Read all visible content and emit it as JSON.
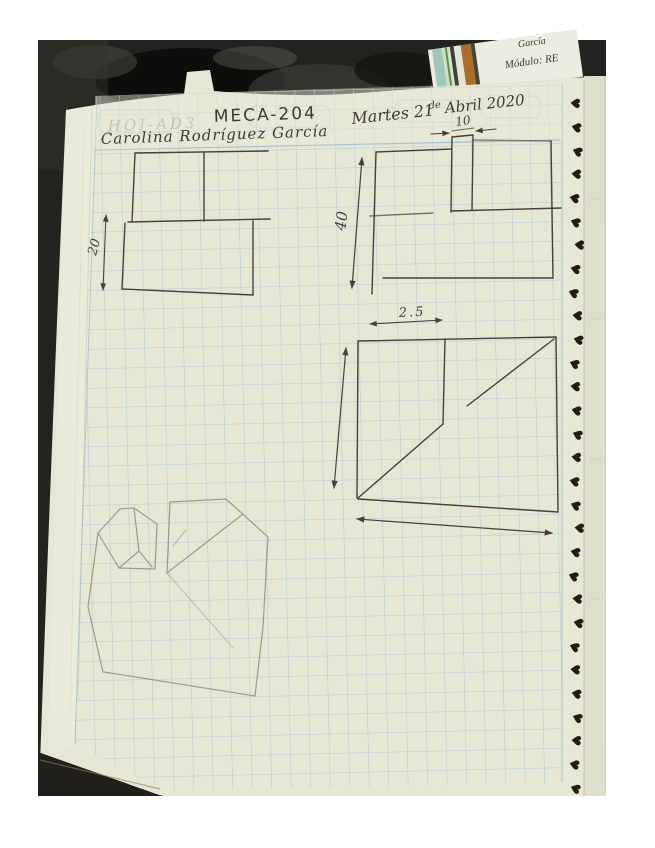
{
  "scene": {
    "description": "Photograph of a spiral-bound graph-paper notebook page with handwritten mechanical-drawing class notes and pencil sketches",
    "page_background": "#ffffff",
    "photo_background": "#23221e",
    "paper_color": "#e6e7d5",
    "grid_color": "#aac6d8",
    "pencil_color": "#46423a",
    "faint_pencil_color": "#8e897b",
    "spiral_color": "#241c11"
  },
  "header": {
    "course_code": "MECA-204",
    "student_name": "Carolina Rodríguez García",
    "date_left": "Martes 21",
    "date_middle": "de",
    "date_right": "Abril 2020",
    "erased_text": "HOI-AD3"
  },
  "background_card": {
    "line1": "García",
    "line2": "Módulo: RE"
  },
  "sketch_dimensions": {
    "left_view_height": "20",
    "center_height": "40",
    "notch_width": "10",
    "front_width": "2.5"
  },
  "spiral_binding": {
    "loop_count": 30
  }
}
